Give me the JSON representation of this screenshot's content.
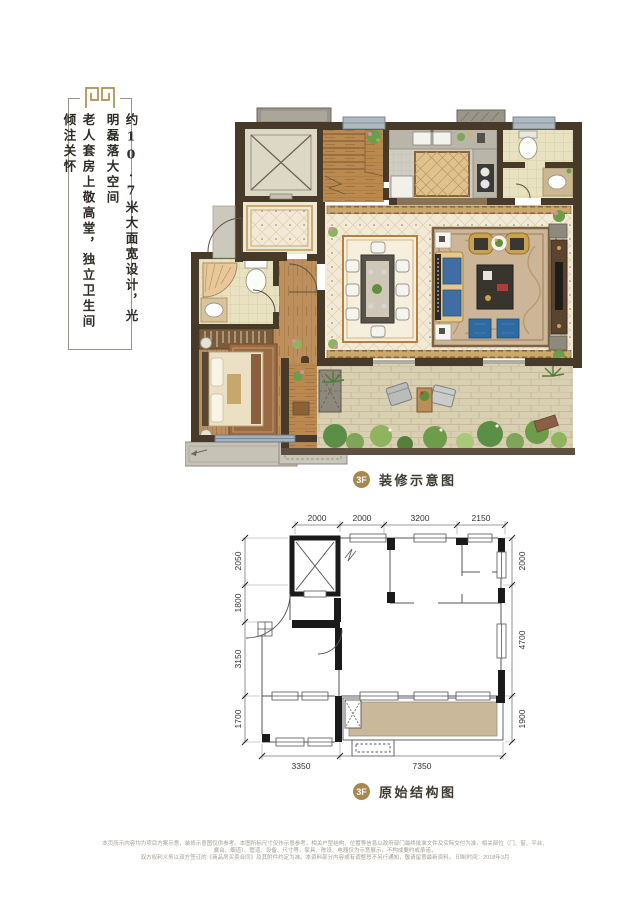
{
  "sidebar": {
    "line1": "约10.7米大面宽设计，光明磊落大空间",
    "line2": "老人套房上敬高堂，独立卫生间倾注关怀"
  },
  "decorated_plan": {
    "floor_badge": "3F",
    "title": "装修示意图"
  },
  "structural_plan": {
    "floor_badge": "3F",
    "title": "原始结构图",
    "dims_top": [
      "2000",
      "2000",
      "3200",
      "2150"
    ],
    "dims_left": [
      "2050",
      "1800",
      "3150",
      "1700"
    ],
    "dims_right": [
      "2000",
      "4700",
      "1900"
    ],
    "dims_bottom": [
      "3350",
      "7350"
    ]
  },
  "footer": {
    "line1": "本页所示内容均为项目方案示意，装修示意图仅供参考。本图所标尺寸仅作示意参考，相关户型结构、位置等信息以政府部门最终批准文件及实际交付为准，相关部位（门、窗、平台、露台、烟道）、管道、设备、尺寸等，家具、陈设、电器仅为示意展示，不构成要约或承诺，",
    "line2": "双方权利义务以双方签订的《商品房买卖合同》及其附件约定为准。本资料部分内容或有调整恕不另行通知，敬请留意最新资料。  印制时间：2018年3月"
  },
  "colors": {
    "accent_gold": "#a8874e",
    "wall_brown": "#473a29",
    "terrace_fill": "#c9b899",
    "window_blue": "#a4b2bd"
  }
}
